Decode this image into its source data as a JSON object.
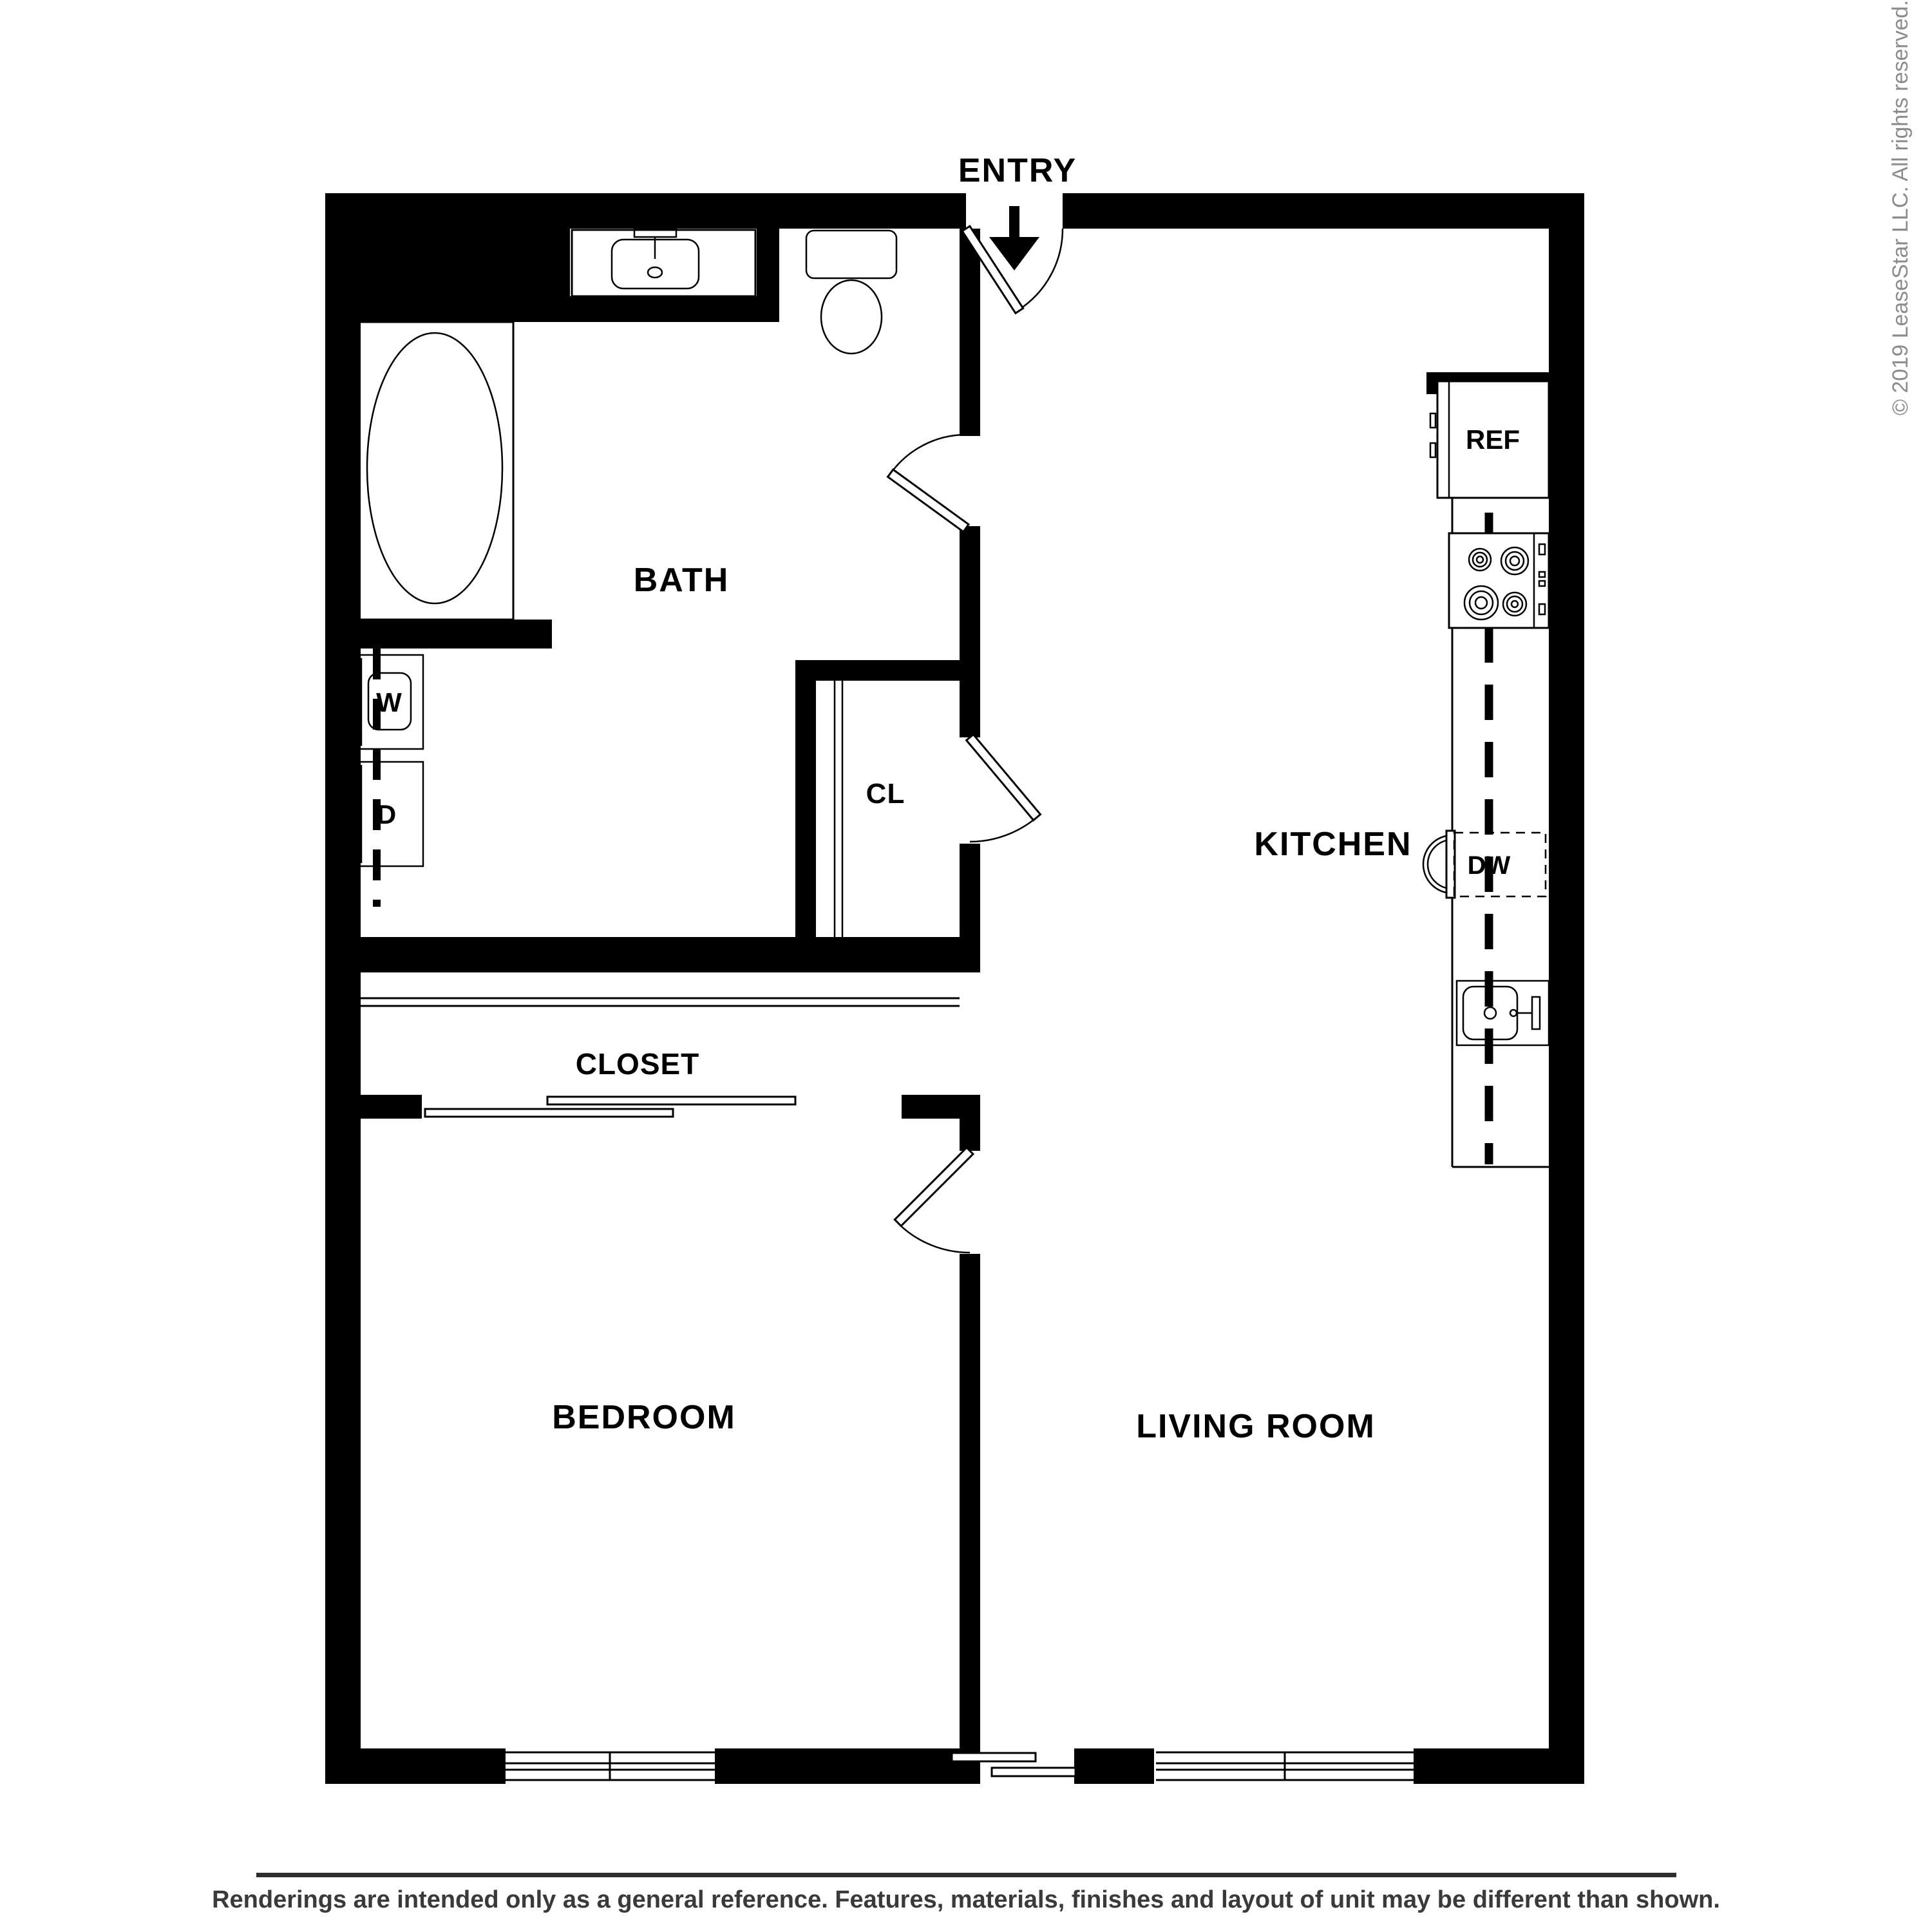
{
  "rooms": {
    "entry": "ENTRY",
    "bath": "BATH",
    "kitchen": "KITCHEN",
    "closet_hall": "CL",
    "closet_bedroom": "CLOSET",
    "bedroom": "BEDROOM",
    "living_room": "LIVING ROOM"
  },
  "appliances": {
    "washer": "W",
    "dryer": "D",
    "refrigerator": "REF",
    "dishwasher": "DW"
  },
  "footer": {
    "disclaimer": "Renderings are intended only as a general reference. Features, materials, finishes and layout of unit may be different than shown."
  },
  "copyright": {
    "text": "© 2019 LeaseStar LLC. All rights reserved."
  },
  "colors": {
    "wall": "#000000",
    "background": "#ffffff",
    "disclaimer_text": "#3a3a3a",
    "copyright_text": "#8c8c8c",
    "rule": "#2d2d2d"
  }
}
